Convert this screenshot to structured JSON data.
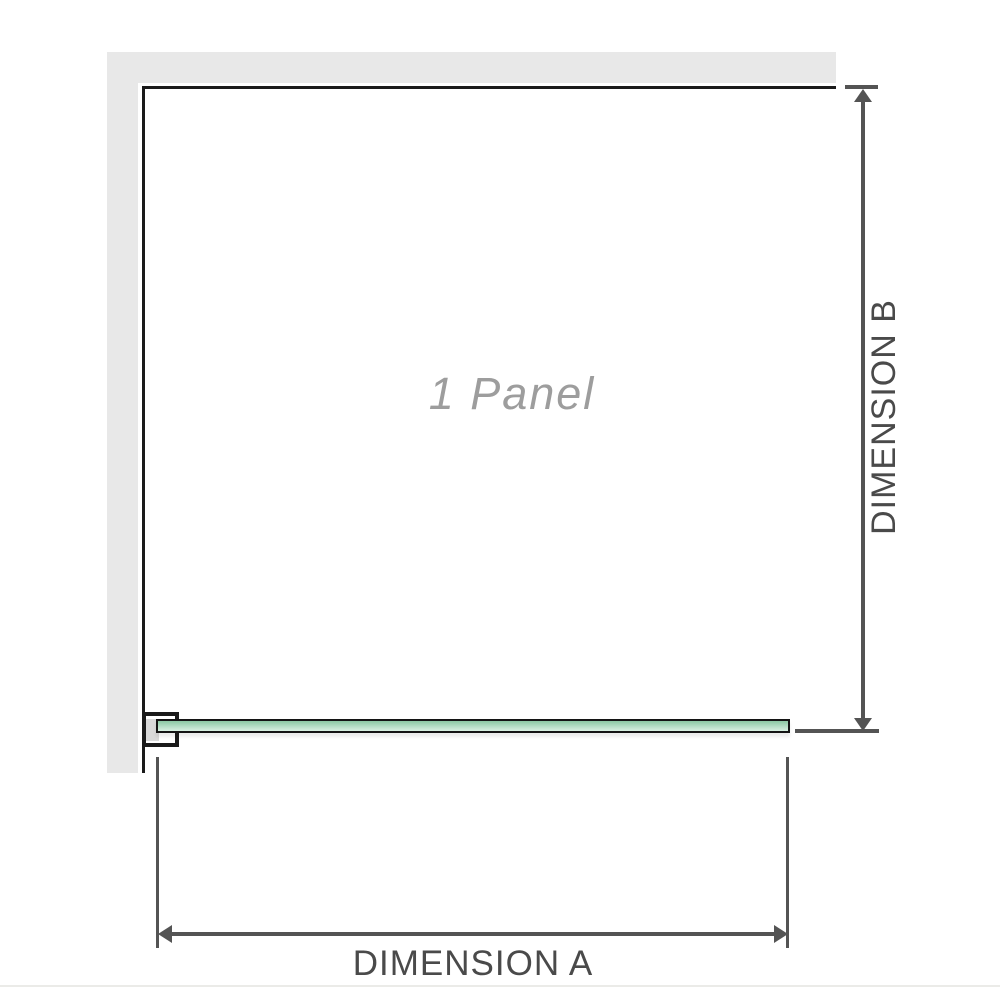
{
  "diagram": {
    "panel_label": "1 Panel",
    "dim_a_label": "DIMENSION A",
    "dim_b_label": "DIMENSION B"
  },
  "colors": {
    "wall_gray": "#e8e8e8",
    "outline_black": "#1a1a1a",
    "dim_gray": "#545454",
    "dim_text_gray": "#4a4a4a",
    "panel_label_gray": "#9d9d9d",
    "glass_green_top": "#8bc8a3",
    "glass_green_bottom": "#d9f0e2",
    "bracket_pad_gray": "#d9d9d9",
    "faint_rule": "#ebebe8"
  }
}
